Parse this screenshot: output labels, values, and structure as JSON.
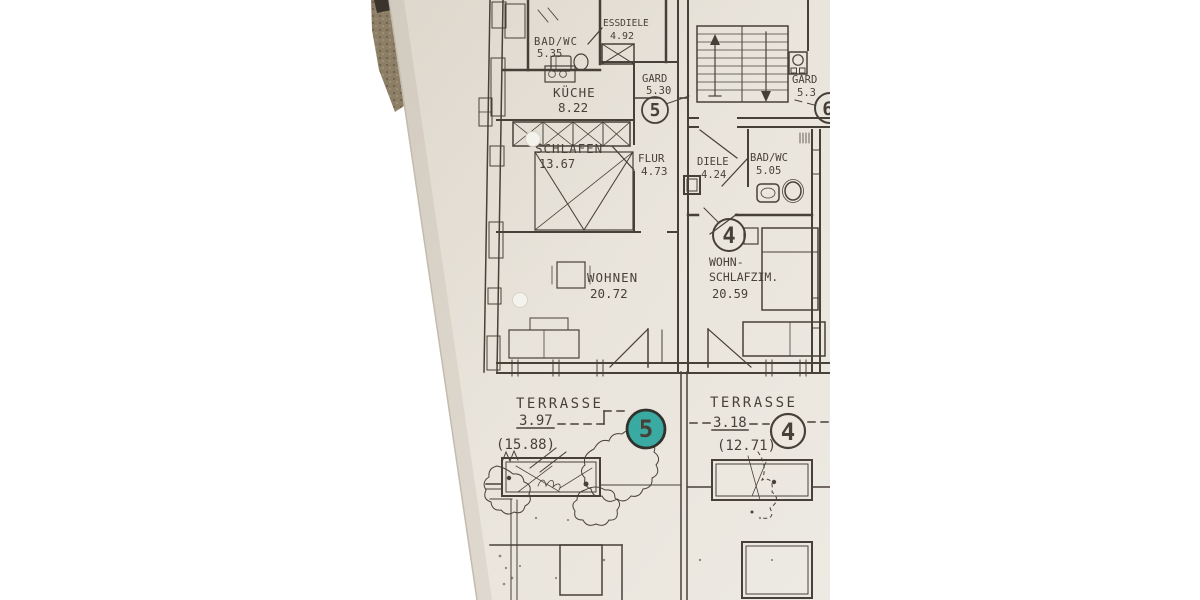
{
  "plan": {
    "rooms": {
      "badwc5": {
        "name": "BAD/WC",
        "area": "5.35"
      },
      "essdiele": {
        "name": "ESSDIELE",
        "area": "4.92"
      },
      "kueche": {
        "name": "KÜCHE",
        "area": "8.22"
      },
      "gard5": {
        "name": "GARD",
        "area": "5.30"
      },
      "schlafen": {
        "name": "SCHLAFEN",
        "area": "13.67"
      },
      "flur": {
        "name": "FLUR",
        "area": "4.73"
      },
      "diele": {
        "name": "DIELE",
        "area": "4.24"
      },
      "badwc4": {
        "name": "BAD/WC",
        "area": "5.05"
      },
      "wohnen": {
        "name": "WOHNEN",
        "area": "20.72"
      },
      "wohnschlafzim": {
        "name_line1": "WOHN-",
        "name_line2": "SCHLAFZIM.",
        "area": "20.59"
      },
      "gard6": {
        "name": "GARD",
        "area": "5.3"
      }
    },
    "terraces": {
      "left": {
        "name": "TERRASSE",
        "counted_area": "3.97",
        "full_area": "(15.88)"
      },
      "right": {
        "name": "TERRASSE",
        "counted_area": "3.18",
        "full_area": "(12.71)"
      }
    },
    "unit_markers": {
      "flur_unit": "5",
      "room_unit": "4",
      "stair_unit": "6",
      "terrace_left_unit": "5",
      "terrace_right_unit": "4"
    },
    "highlight": {
      "marked_unit": "5",
      "marker_color": "#2ba59d"
    },
    "colors": {
      "ink": "#3a332b",
      "paper": "#e8e3da",
      "background": "#ffffff",
      "carpet": "#8d7e66"
    }
  }
}
